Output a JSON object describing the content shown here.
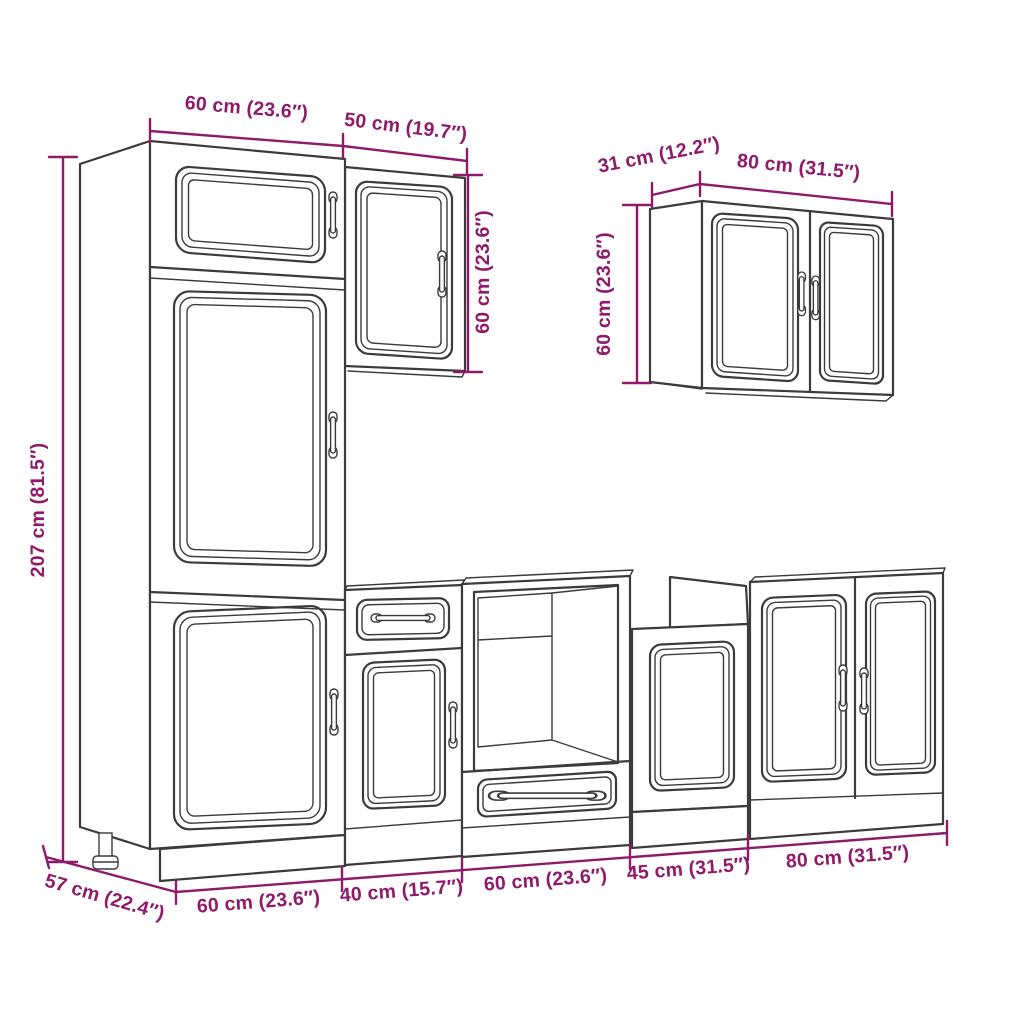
{
  "diagram": {
    "kind": "kitchen-cabinet-set-technical-drawing",
    "colors": {
      "dimension": "#8f1a6b",
      "line": "#3b3b3b",
      "background": "#ffffff"
    },
    "dimensions": {
      "tall_cabinet_width": "60 cm (23.6″)",
      "wall_cabinet_left_width": "50 cm (19.7″)",
      "wall_cabinet_left_height": "60 cm (23.6″)",
      "tall_cabinet_height": "207 cm (81.5″)",
      "wall_cabinet_right_depth": "31 cm (12.2″)",
      "wall_cabinet_right_width": "80 cm (31.5″)",
      "wall_cabinet_right_height": "60 cm (23.6″)",
      "base_depth": "57 cm (22.4″)",
      "base_run": [
        "60 cm (23.6″)",
        "40 cm (15.7″)",
        "60 cm (23.6″)",
        "45 cm (31.5″)",
        "80 cm (31.5″)"
      ]
    }
  }
}
